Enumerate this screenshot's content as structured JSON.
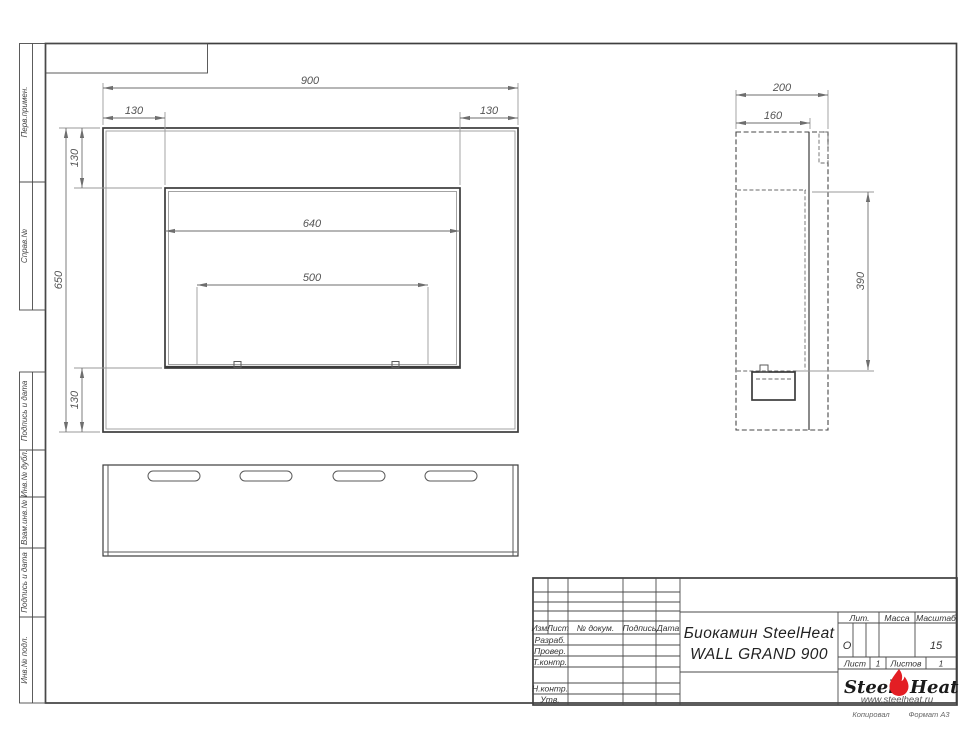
{
  "drawing": {
    "stamps_left": [
      "Перв.примен.",
      "Справ.№",
      "Подпись и дата",
      "Инв.№ дубл.",
      "Взам.инв.№",
      "Подпись и дата",
      "Инв.№ подл."
    ],
    "dims": {
      "front_width": "900",
      "front_left": "130",
      "front_right": "130",
      "front_height": "650",
      "front_top": "130",
      "front_bottom": "130",
      "opening_width": "640",
      "burner_width": "500",
      "side_depth": "200",
      "side_inner": "160",
      "side_height": "390"
    },
    "title_block": {
      "col_izm": "Изм.",
      "col_list": "Лист",
      "col_doc": "№ докум.",
      "col_sign": "Подпись",
      "col_date": "Дата",
      "row_razrab": "Разраб.",
      "row_prover": "Провер.",
      "row_tkontr": "Т.контр.",
      "row_nkontr": "Н.контр.",
      "row_utv": "Утв.",
      "title_line1": "Биокамин SteelHeat",
      "title_line2": "WALL GRAND 900",
      "lit_label": "Лит.",
      "lit_value": "О",
      "mass_label": "Масса",
      "scale_label": "Масштаб",
      "scale_value": "15",
      "sheet_label": "Лист",
      "sheet_value": "1",
      "sheets_label": "Листов",
      "sheets_value": "1"
    },
    "logo": {
      "steel": "Steel",
      "heat": "Heat",
      "url": "www.steelheat.ru"
    },
    "footer": {
      "copy": "Копировал",
      "format": "Формат А3"
    },
    "colors": {
      "flame": "#e31e24",
      "line": "#3c3c3c",
      "dim": "#666666"
    }
  }
}
